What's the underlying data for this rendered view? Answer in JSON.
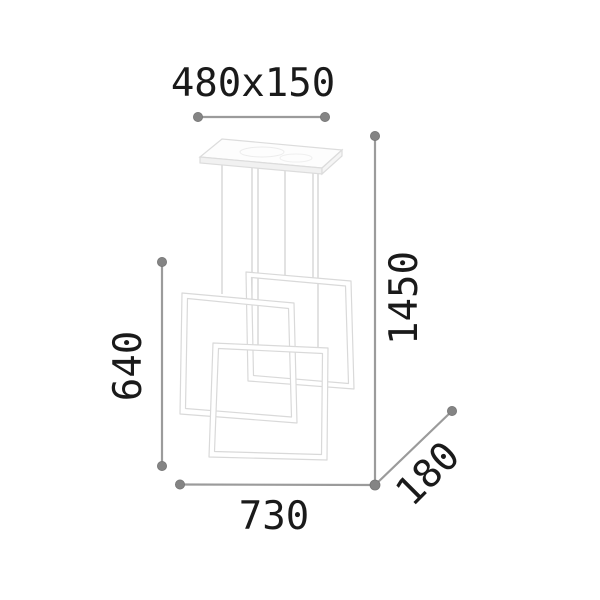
{
  "diagram": {
    "labels": {
      "canopy_size": "480x150",
      "total_height": "1450",
      "frames_height": "640",
      "overall_width": "730",
      "depth": "180"
    },
    "colors": {
      "background": "#ffffff",
      "dimension_line": "#9b9b9b",
      "dimension_dot": "#848484",
      "label_text": "#1a1a1a",
      "lamp_outline": "#d9d9d9",
      "lamp_fill": "#ffffff",
      "canopy_shade": "#f1f1f1"
    }
  }
}
